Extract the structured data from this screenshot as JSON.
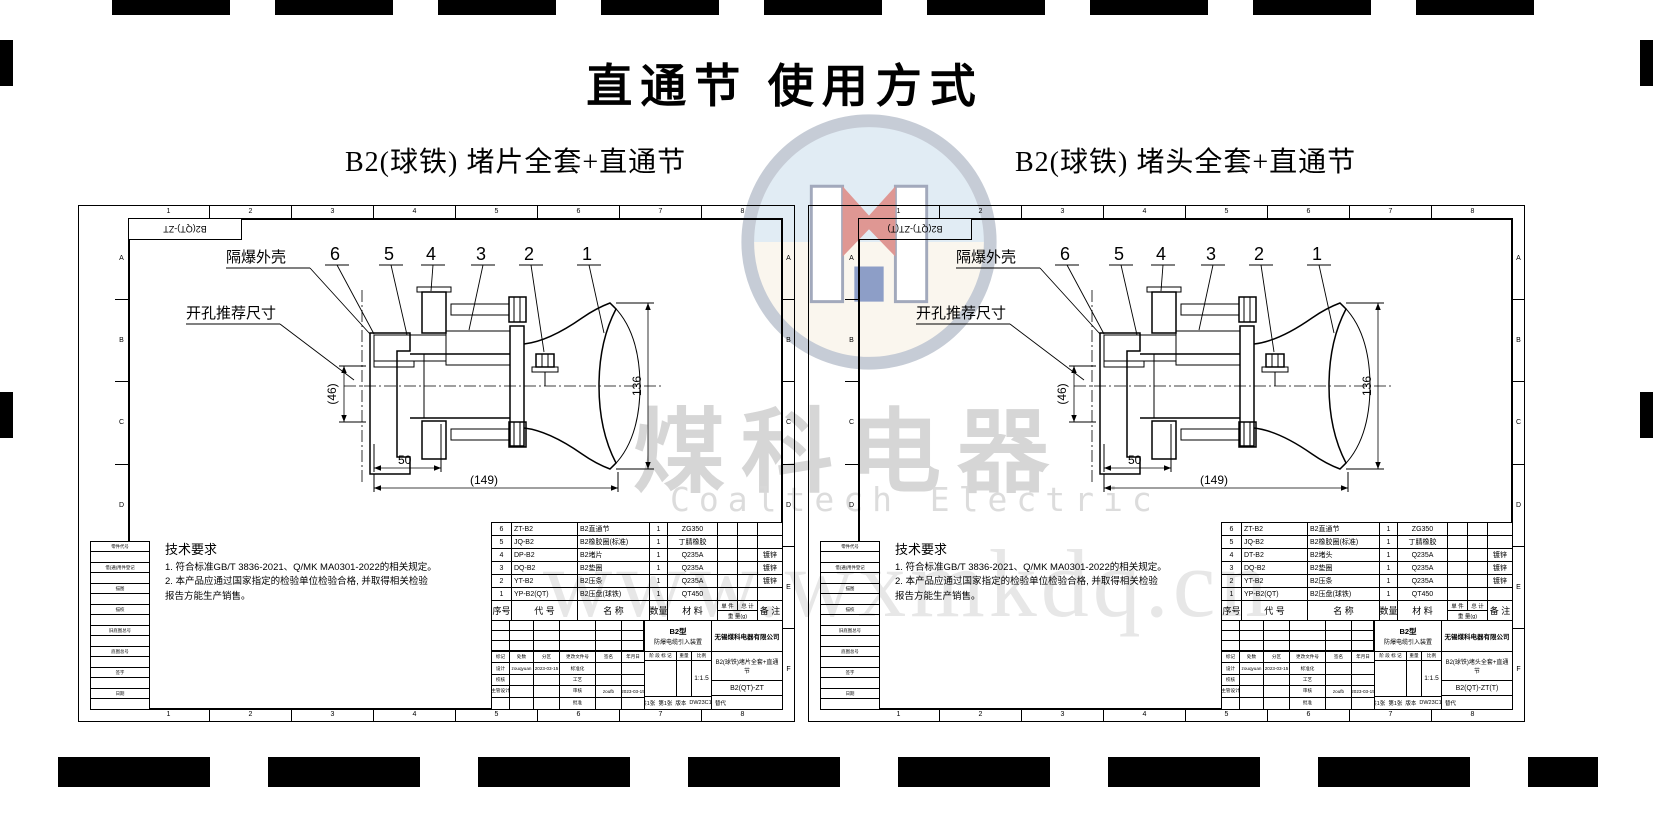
{
  "page": {
    "title": "直通节 使用方式"
  },
  "watermark": {
    "cn": "煤科电器",
    "en": "Coaltech Electric",
    "url": "www.wxmkdq.cn"
  },
  "shared": {
    "zone_numbers": [
      "1",
      "2",
      "3",
      "4",
      "5",
      "6",
      "7",
      "8"
    ],
    "zone_letters": [
      "A",
      "B",
      "C",
      "D",
      "E",
      "F"
    ],
    "callouts": [
      "6",
      "5",
      "4",
      "3",
      "2",
      "1"
    ],
    "labels": {
      "shell": "隔爆外壳",
      "opening": "开孔推荐尺寸"
    },
    "dims": {
      "d46": "(46)",
      "d50": "50",
      "d149": "(149)",
      "d136": "136"
    },
    "tech_title": "技术要求",
    "tech_lines": [
      "1. 符合标准GB/T 3836-2021、Q/MK MA0301-2022的相关规定。",
      "2. 本产品应通过国家指定的检验单位检验合格, 并取得相关检验",
      "    报告方能生产销售。"
    ],
    "bom_header": {
      "no": "序号",
      "code": "代  号",
      "name": "名  称",
      "qty": "数量",
      "material": "材  料",
      "unit": "单 件",
      "total": "总 计",
      "weight": "重 量(g)",
      "remark": "备 注"
    },
    "sidebar_fields": [
      "零件代号",
      "借(通)用件登记",
      "描图",
      "描校",
      "旧底图总号",
      "底图总号",
      "签字",
      "日期"
    ],
    "titleblock": {
      "rev_header": [
        "标记",
        "处数",
        "分区",
        "更改文件号",
        "签名",
        "年月日"
      ],
      "design_label": "设计",
      "designer": "zouqyuan",
      "design_date": "2023-03-15",
      "std_label": "标准化",
      "check_label": "校核",
      "process_label": "工艺",
      "chief_label": "主管设计",
      "audit_label": "审核",
      "auditor": "zoufb",
      "audit_date": "2023-03-15",
      "approve_label": "批准",
      "product_type": "B2型",
      "product_desc": "防爆电缆引入装置",
      "stage_label": "阶 段 标 记",
      "weight_label": "重量",
      "scale_label": "比例",
      "scale": "1:1.5",
      "sheet1": "共1张",
      "sheet2": "第1张",
      "version_label": "版本",
      "version": "DW23C15",
      "replace_label": "替代",
      "company": "无锡煤科电器有限公司"
    }
  },
  "panels": [
    {
      "subtitle": "B2(球铁) 堵片全套+直通节",
      "corner_code": "B2(QT)-ZT",
      "drawing_title": "B2(球铁)堵片全套+直通节",
      "drawing_code": "B2(QT)-ZT",
      "bom_rows": [
        [
          "6",
          "ZT-B2",
          "B2直通节",
          "1",
          "ZG350",
          ""
        ],
        [
          "5",
          "JQ-B2",
          "B2橡胶圈(标准)",
          "1",
          "丁腈橡胶",
          ""
        ],
        [
          "4",
          "DP-B2",
          "B2堵片",
          "1",
          "Q235A",
          "镀锌"
        ],
        [
          "3",
          "DQ-B2",
          "B2垫圈",
          "1",
          "Q235A",
          "镀锌"
        ],
        [
          "2",
          "YT-B2",
          "B2压条",
          "1",
          "Q235A",
          "镀锌"
        ],
        [
          "1",
          "YP-B2(QT)",
          "B2压盘(球铁)",
          "1",
          "QT450",
          ""
        ]
      ]
    },
    {
      "subtitle": "B2(球铁) 堵头全套+直通节",
      "corner_code": "B2(QT)-ZT(T)",
      "drawing_title": "B2(球铁)堵头全套+直通节",
      "drawing_code": "B2(QT)-ZT(T)",
      "bom_rows": [
        [
          "6",
          "ZT-B2",
          "B2直通节",
          "1",
          "ZG350",
          ""
        ],
        [
          "5",
          "JQ-B2",
          "B2橡胶圈(标准)",
          "1",
          "丁腈橡胶",
          ""
        ],
        [
          "4",
          "DT-B2",
          "B2堵头",
          "1",
          "Q235A",
          "镀锌"
        ],
        [
          "3",
          "DQ-B2",
          "B2垫圈",
          "1",
          "Q235A",
          "镀锌"
        ],
        [
          "2",
          "YT-B2",
          "B2压条",
          "1",
          "Q235A",
          "镀锌"
        ],
        [
          "1",
          "YP-B2(QT)",
          "B2压盘(球铁)",
          "1",
          "QT450",
          ""
        ]
      ]
    }
  ]
}
